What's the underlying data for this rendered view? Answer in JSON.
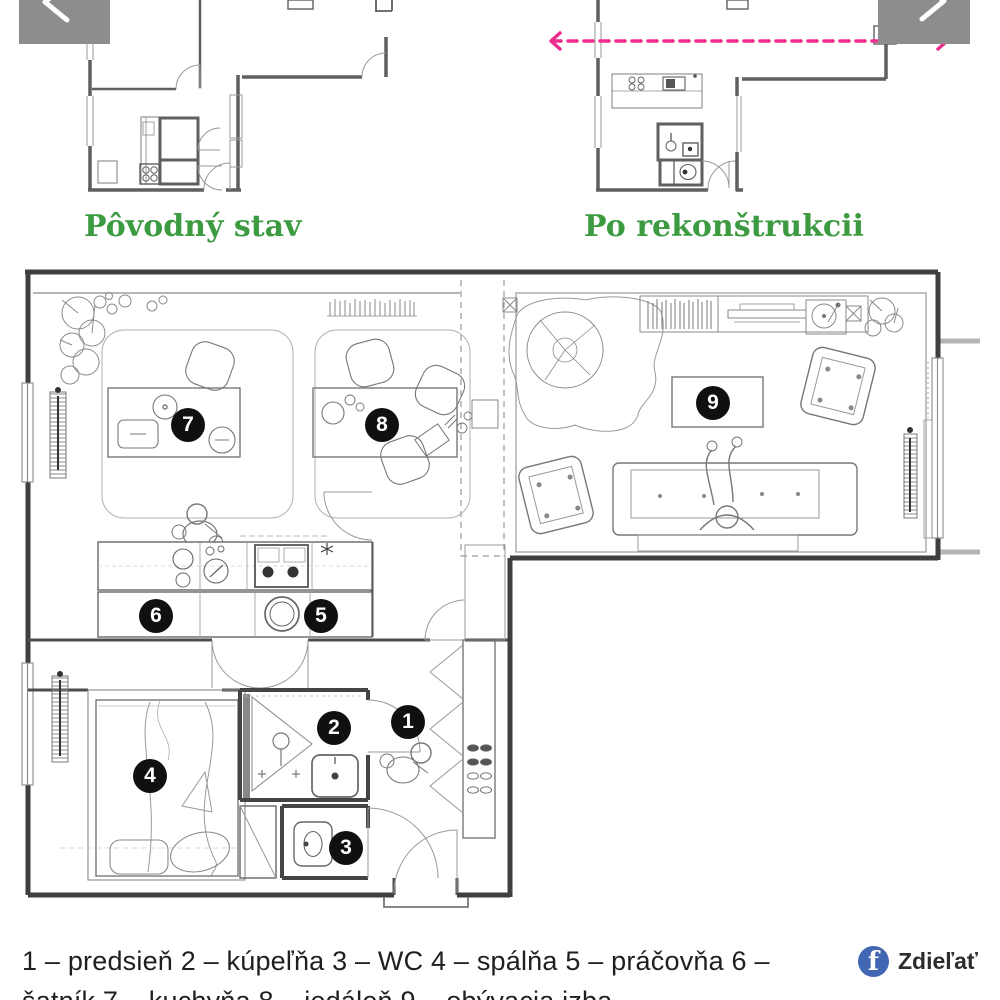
{
  "colors": {
    "heading_green": "#3c9b41",
    "arrow_pink": "#ee2d8e",
    "facebook_blue": "#4267B2"
  },
  "plans": {
    "before": {
      "label": "Pôvodný stav"
    },
    "after": {
      "label": "Po rekonštrukcii"
    }
  },
  "main_plan": {
    "rooms": [
      {
        "number": "1",
        "name": "predsieň",
        "x": 408,
        "y": 722
      },
      {
        "number": "2",
        "name": "kúpeľňa",
        "x": 334,
        "y": 728
      },
      {
        "number": "3",
        "name": "WC",
        "x": 346,
        "y": 848
      },
      {
        "number": "4",
        "name": "spálňa",
        "x": 150,
        "y": 776
      },
      {
        "number": "5",
        "name": "práčovňa",
        "x": 321,
        "y": 616
      },
      {
        "number": "6",
        "name": "šatník",
        "x": 156,
        "y": 616
      },
      {
        "number": "7",
        "name": "kuchyňa",
        "x": 188,
        "y": 425
      },
      {
        "number": "8",
        "name": "jedáleň",
        "x": 382,
        "y": 425
      },
      {
        "number": "9",
        "name": "obývacia izba",
        "x": 713,
        "y": 403
      }
    ]
  },
  "legend": {
    "line1": "1 – predsieň 2 – kúpeľňa 3 – WC 4 – spálňa 5 – práčovňa 6 –",
    "line2": "šatník 7 – kuchyňa 8 – jedáleň 9 – obývacia izba"
  },
  "share": {
    "label": "Zdieľať",
    "icon_glyph": "f"
  }
}
